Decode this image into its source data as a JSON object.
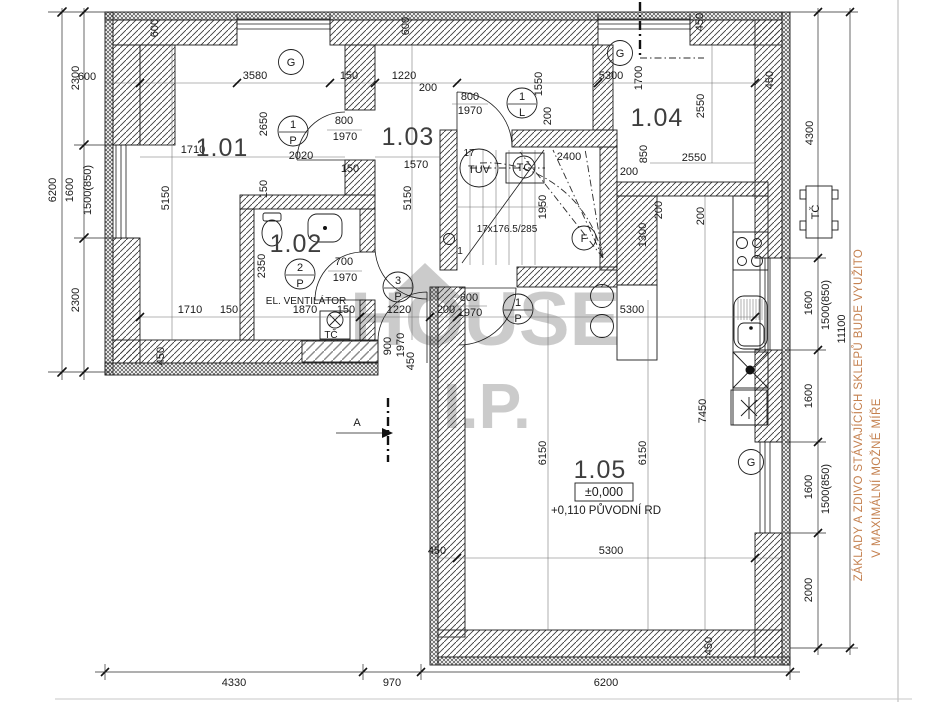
{
  "rooms": {
    "r101": "1.01",
    "r102": "1.02",
    "r103": "1.03",
    "r104": "1.04",
    "r105": "1.05"
  },
  "levels": {
    "zero": "±0,000",
    "orig": "+0,110 PŮVODNÍ RD"
  },
  "stair": {
    "formula": "17x176.5/285",
    "first": "1",
    "last": "17"
  },
  "texts": {
    "vent": "EL. VENTILÁTOR",
    "section": "A"
  },
  "badge": {
    "n1": "1",
    "n2": "2",
    "n3": "3",
    "p": "P",
    "l": "L",
    "g": "G",
    "f": "F",
    "tuv": "TUV",
    "tc": "TČ"
  },
  "watermark": {
    "word": "HOUSE",
    "sub": "I.P."
  },
  "note": {
    "line1": "ZÁKLADY A ZDIVO STÁVAJÍCÍCH SKLEPŮ BUDE VYUŽITO",
    "line2": "V MAXIMÁLNÍ MOŽNÉ MÍŘE",
    "color": "#c4804f"
  },
  "v": {
    "d150": "150",
    "d200": "200",
    "d450": "450",
    "d600": "600",
    "d700": "700",
    "d800": "800",
    "d850": "850",
    "d900": "900",
    "d970": "970",
    "d1220": "1220",
    "d1300": "1300",
    "d1500": "1500(850)",
    "d1550": "1550",
    "d1570": "1570",
    "d1600": "1600",
    "d1700": "1700",
    "d1710": "1710",
    "d1870": "1870",
    "d1950": "1950",
    "d1970": "1970",
    "d2000": "2000",
    "d2020": "2020",
    "d2300": "2300",
    "d2350": "2350",
    "d2400": "2400",
    "d2550": "2550",
    "d2650": "2650",
    "d3580": "3580",
    "d4300": "4300",
    "d4330": "4330",
    "d5150": "5150",
    "d5300": "5300",
    "d6150": "6150",
    "d6200": "6200",
    "d7450": "7450",
    "d11100": "11100"
  }
}
